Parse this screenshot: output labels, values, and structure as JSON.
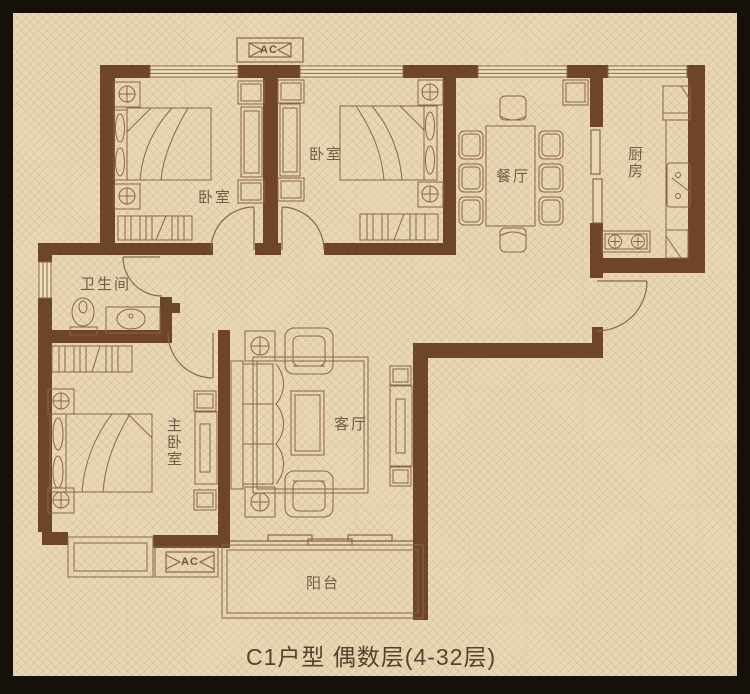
{
  "caption": "C1户型 偶数层(4-32层)",
  "rooms": {
    "bedroom_top_left": {
      "label": "卧室"
    },
    "bedroom_top_middle": {
      "label": "卧室"
    },
    "dining_room": {
      "label": "餐厅"
    },
    "kitchen": {
      "label": "厨房"
    },
    "bathroom": {
      "label": "卫生间"
    },
    "master_bedroom": {
      "label": "主卧室"
    },
    "living_room": {
      "label": "客厅"
    },
    "balcony": {
      "label": "阳台"
    }
  },
  "ac_units": {
    "top": "AC",
    "bottom": "AC"
  },
  "colors": {
    "wall": "#6f4527",
    "furniture_line": "#8a6645",
    "paper": "#e9d7b4",
    "frame": "#16100a",
    "room_label_text": "#6e5e47",
    "caption_text": "#55422e"
  }
}
